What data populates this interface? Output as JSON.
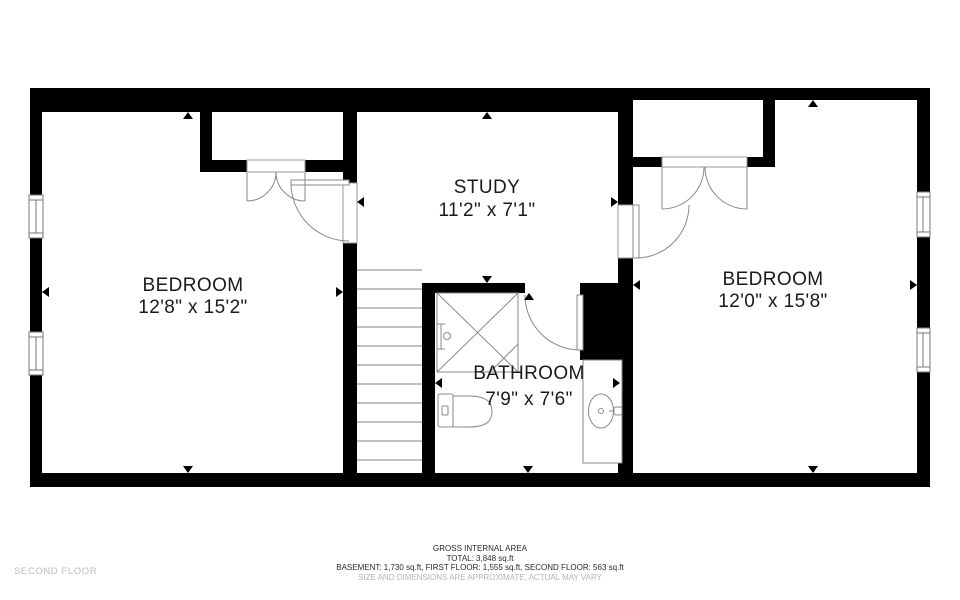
{
  "floorplan": {
    "floor_label": "SECOND FLOOR",
    "rooms": {
      "bedroom_left": {
        "name": "BEDROOM",
        "dims": "12'8\" x 15'2\""
      },
      "study": {
        "name": "STUDY",
        "dims": "11'2\" x 7'1\""
      },
      "bathroom": {
        "name": "BATHROOM",
        "dims": "7'9\" x 7'6\""
      },
      "bedroom_right": {
        "name": "BEDROOM",
        "dims": "12'0\" x 15'8\""
      }
    },
    "footer": {
      "line1": "GROSS INTERNAL AREA",
      "line2": "TOTAL: 3,848 sq.ft",
      "line3": "BASEMENT: 1,730 sq.ft, FIRST FLOOR: 1,555 sq.ft, SECOND FLOOR: 563 sq.ft",
      "line4": "SIZE AND DIMENSIONS ARE APPROXIMATE, ACTUAL MAY VARY"
    },
    "colors": {
      "wall": "#000000",
      "fixture": "#888888",
      "tread": "#9a9a9a",
      "muted": "#b5b5b5"
    }
  }
}
